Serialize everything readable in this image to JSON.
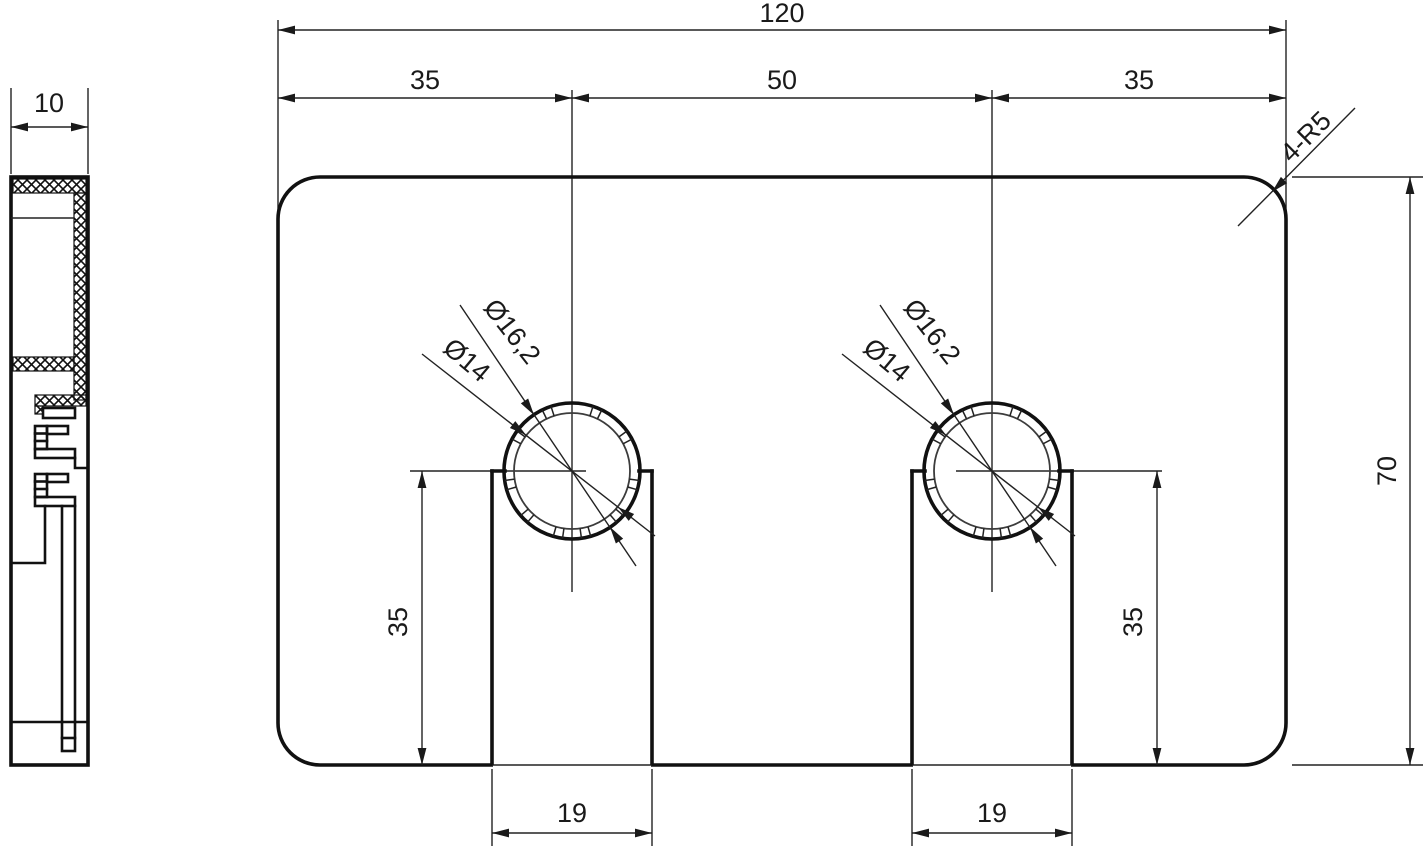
{
  "dims": {
    "overall_width": "120",
    "left_offset": "35",
    "center_spacing": "50",
    "right_offset": "35",
    "thickness": "10",
    "corner_radius_note": "4-R5",
    "overall_height": "70",
    "left_hole": {
      "outer_dia": "Ø16,2",
      "inner_dia": "Ø14",
      "slot_depth": "35",
      "slot_width": "19"
    },
    "right_hole": {
      "outer_dia": "Ø16,2",
      "inner_dia": "Ø14",
      "slot_depth": "35",
      "slot_width": "19"
    }
  }
}
